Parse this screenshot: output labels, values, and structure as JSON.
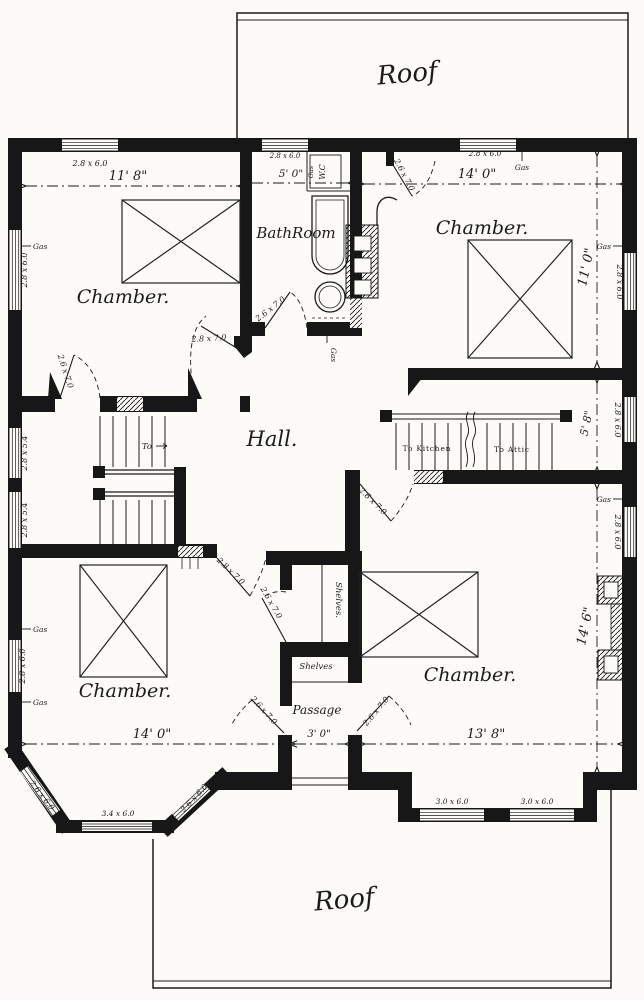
{
  "labels": {
    "roof": "Roof",
    "chamber": "Chamber.",
    "bath_room": "BathRoom",
    "wc": "W.C",
    "hall": "Hall.",
    "passage": "Passage",
    "shelves_tall": "Shelves.",
    "shelves_low": "Shelves",
    "to_kitchen": "To Kitchen",
    "to_attic": "To Attic",
    "to": "To",
    "gas": "Gas"
  },
  "dimensions": {
    "chamber_nw_width": "11' 8\"",
    "bath_width": "5' 0\"",
    "chamber_ne_width": "14' 0\"",
    "chamber_ne_depth": "11' 0\"",
    "stair_hall_depth": "5' 8\"",
    "chamber_se_depth": "14' 6\"",
    "chamber_sw_width": "14' 0\"",
    "passage_width": "3' 0\"",
    "chamber_se_width": "13' 8\""
  },
  "window_sizes": {
    "s2860": "2.8 x 6.0",
    "s2854": "2.8 x 5.4",
    "s2660": "2.6 x 6.0",
    "s3460": "3.4 x 6.0",
    "s3060": "3.0 x 6.0"
  },
  "door_sizes": {
    "s2670": "2.6 x 7.0",
    "s2870": "2.8 x 7.0"
  }
}
